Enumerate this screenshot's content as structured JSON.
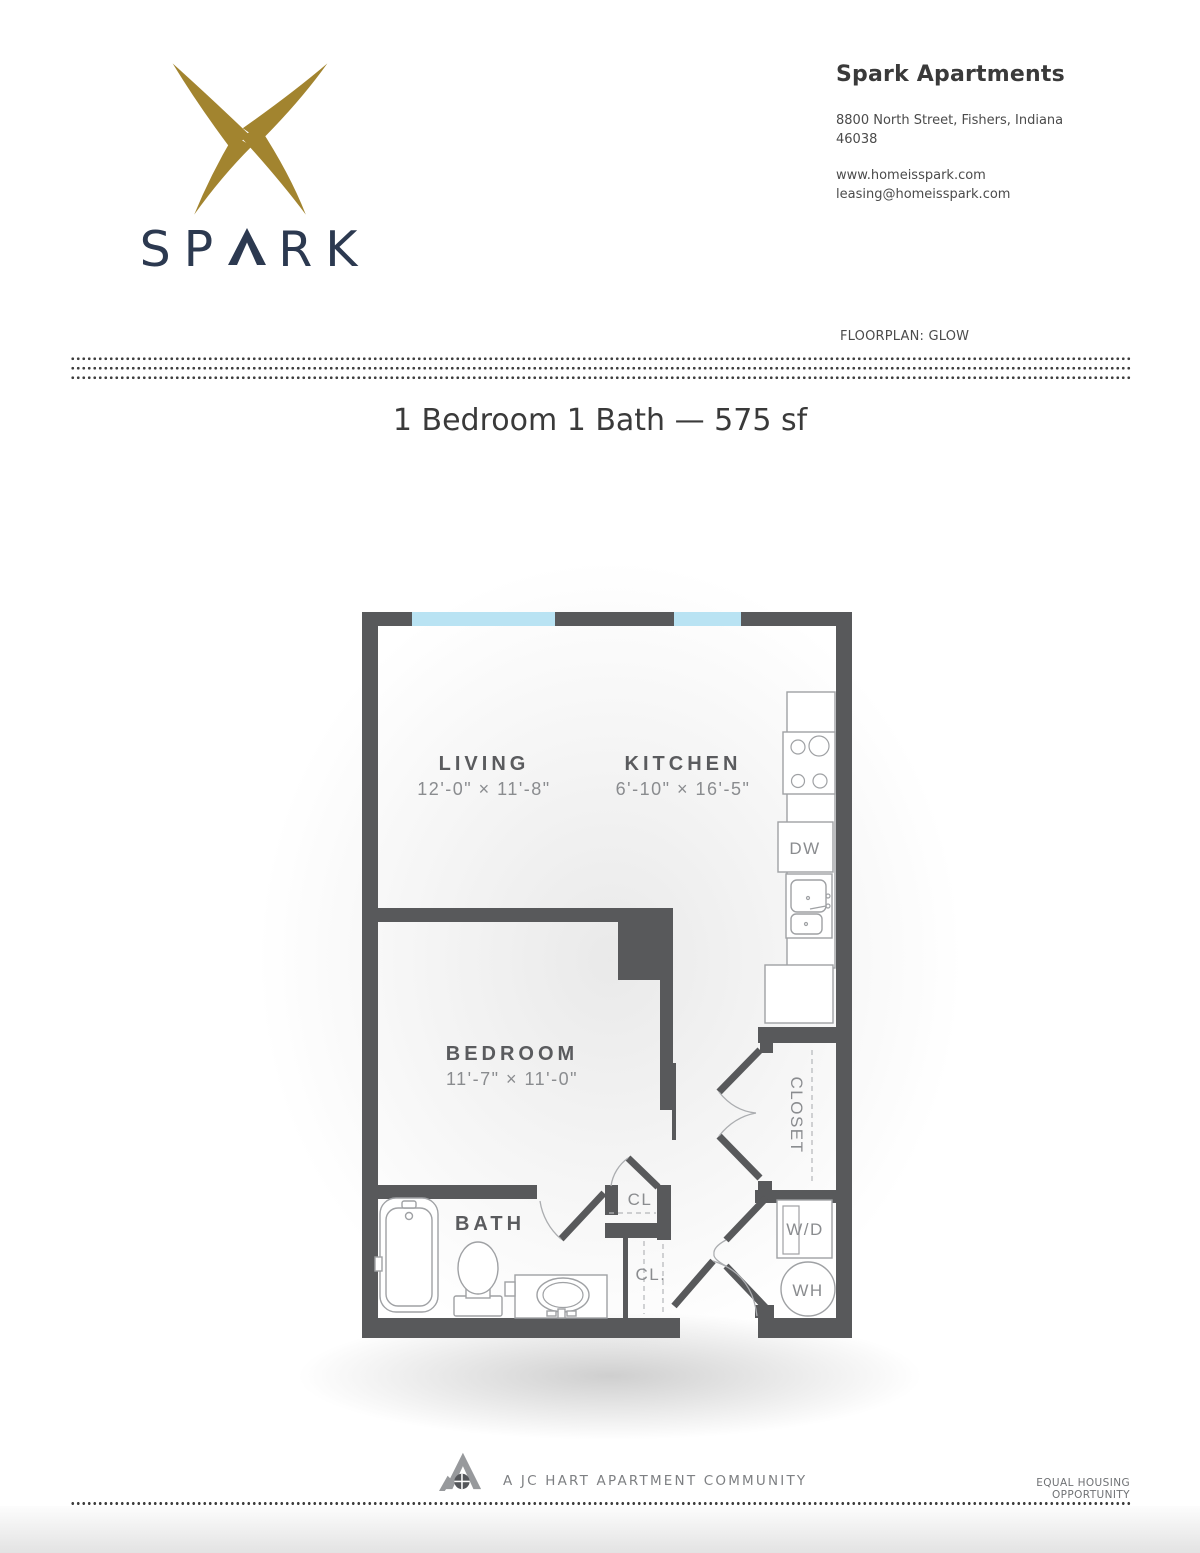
{
  "brand": {
    "wordmark": "SPARK",
    "wordmark_prefix": "SP",
    "wordmark_suffix": "RK"
  },
  "header": {
    "property_name": "Spark Apartments",
    "address_line1": "8800 North Street, Fishers, Indiana",
    "address_line2": "46038",
    "website": "www.homeisspark.com",
    "email": "leasing@homeisspark.com",
    "floorplan_label": "FLOORPLAN: GLOW"
  },
  "title": "1 Bedroom 1 Bath — 575 sf",
  "plan": {
    "living": {
      "name": "LIVING",
      "dims": "12'-0\" × 11'-8\""
    },
    "kitchen": {
      "name": "KITCHEN",
      "dims": "6'-10\" × 16'-5\""
    },
    "bedroom": {
      "name": "BEDROOM",
      "dims": "11'-7\" × 11'-0\""
    },
    "bath": {
      "name": "BATH"
    },
    "closet": {
      "name": "CLOSET"
    },
    "labels": {
      "dishwasher": "DW",
      "washer_dryer": "W/D",
      "water_heater": "WH",
      "closet_upper": "CL",
      "closet_lower": "CL."
    }
  },
  "footer": {
    "community": "A JC HART APARTMENT COMMUNITY",
    "equal_housing": "EQUAL HOUSING OPPORTUNITY"
  },
  "colors": {
    "logo_gold": "#a2842f",
    "logo_navy": "#2c3950",
    "wall_gray": "#58595b",
    "window_blue": "#b9e3f3",
    "fixture_gray": "#9fa1a4",
    "room_label": "#5a5b5e",
    "dim_text": "#8a8c8f"
  }
}
